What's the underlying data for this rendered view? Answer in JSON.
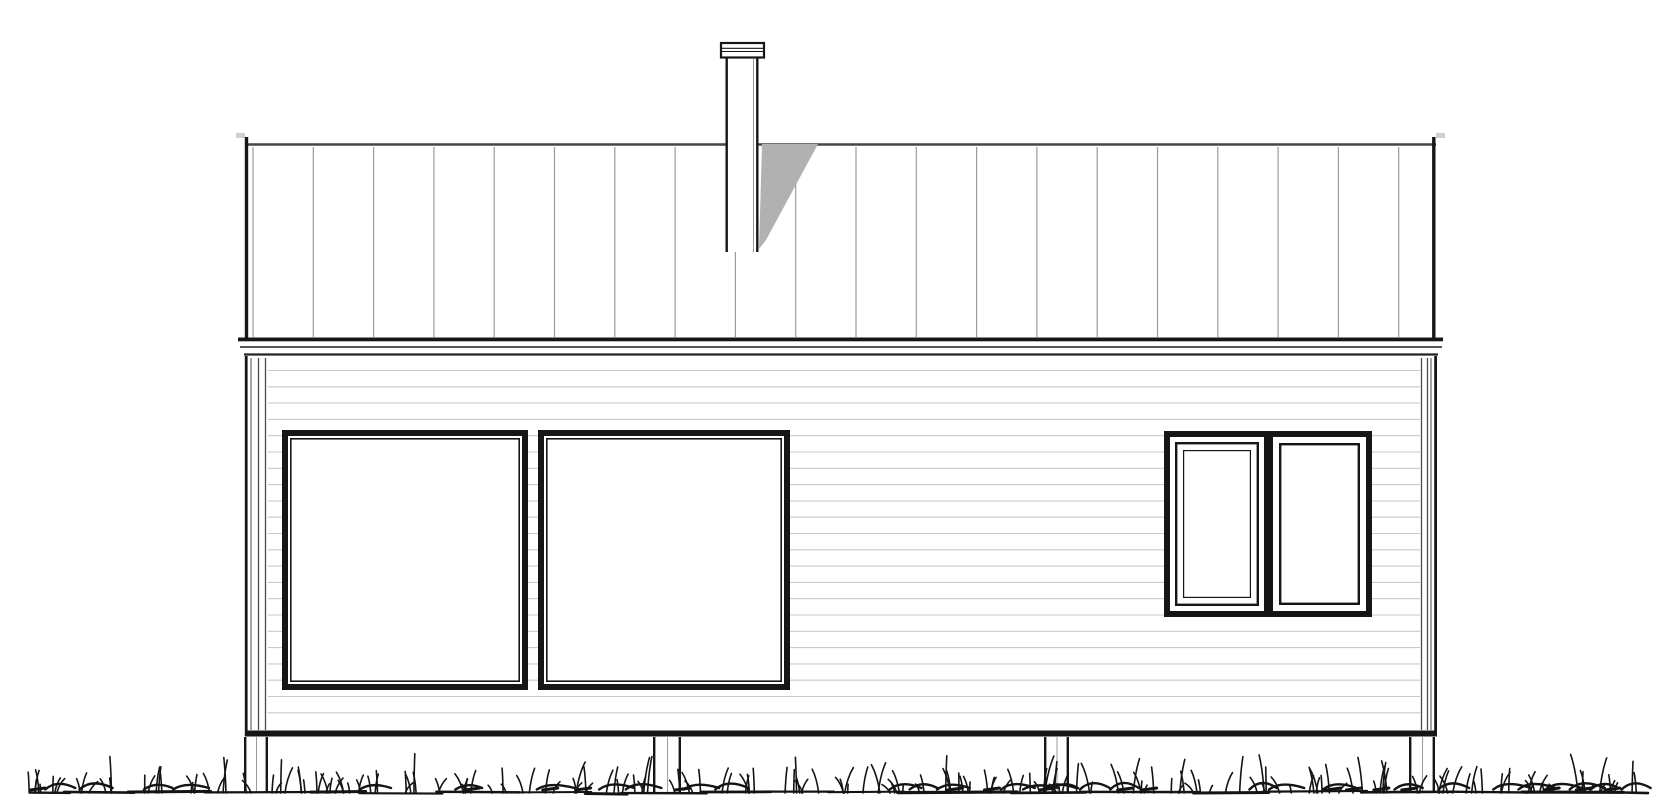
{
  "scene": {
    "width": 1670,
    "height": 800,
    "background": "#ffffff"
  },
  "palette": {
    "line_dark": "#161616",
    "line_medium": "#3f3f3f",
    "roof_top_line": "#474747",
    "roof_seam_gray": "#9b9b9b",
    "siding_gray": "#c9c9c9",
    "shadow_gray": "#b1b1b1",
    "grass_black": "#141414",
    "fill_white": "#ffffff",
    "post_inner_gray": "#999999",
    "corner_line_gray": "#4a4a4a"
  },
  "roof": {
    "x": 245,
    "right": 1436,
    "top_line_y": 144.5,
    "eave_y": 337,
    "edge_left_x": 246.5,
    "edge_right_x": 1433.8,
    "edge_top_y": 137,
    "edge_bottom_y": 338.5,
    "seam_first_x": 253,
    "seam_spacing": 60.3,
    "seam_count": 20,
    "seam_top_y": 147,
    "seam_bottom_y": 337
  },
  "fascia": {
    "board": {
      "x": 238,
      "y": 337.5,
      "w": 1205,
      "h": 3.8
    },
    "mid_line": {
      "x1": 240,
      "x2": 1442,
      "y": 347,
      "w": 1.8
    },
    "bottom_line": {
      "x1": 244,
      "x2": 1438,
      "y": 354.5,
      "w": 2.2
    }
  },
  "chimney": {
    "cap": {
      "x": 721,
      "y": 43,
      "w": 43,
      "h": 14.5,
      "inner_line_ys": [
        48.3,
        51.5
      ]
    },
    "body": {
      "x": 725.5,
      "y": 57,
      "w": 33,
      "bottom_y": 252
    }
  },
  "chimney_shadow": {
    "points": "762,144 818,144 766,240 759,249"
  },
  "wall": {
    "x": 245,
    "y": 356,
    "w": 1192,
    "bottom_y": 737,
    "left_edge_x": 246.2,
    "right_edge_x": 1435.6,
    "siding_first_y": 370.5,
    "siding_pitch": 16.3,
    "siding_last_y": 727,
    "siding_left_x": 268,
    "siding_right_x": 1420,
    "base_band": {
      "y": 730.5,
      "h": 6
    }
  },
  "corner_boards": {
    "left": {
      "thin_x": 251,
      "lines_x": [
        258.5,
        265.5
      ]
    },
    "right": {
      "thin_x": 1431,
      "lines_x": [
        1421.5,
        1427.5
      ]
    },
    "top_y": 358,
    "bottom_y": 730
  },
  "windows": {
    "large": [
      {
        "x": 282,
        "y": 430,
        "w": 246,
        "h": 260,
        "frame": 6,
        "inner_inset": 8.8,
        "inner_stroke": 1.6
      },
      {
        "x": 538,
        "y": 430,
        "w": 252,
        "h": 260,
        "frame": 6,
        "inner_inset": 8.8,
        "inner_stroke": 1.6
      }
    ],
    "pair": {
      "x": 1164,
      "y": 431,
      "w": 208,
      "h": 186,
      "frame": 6,
      "divider": {
        "x": 1264,
        "w": 9
      },
      "casement_sash_outer": {
        "x1": 1175,
        "y1": 442,
        "x2": 1259,
        "y2": 606,
        "stroke": 2.4
      },
      "casement_sash_inner": {
        "x1": 1183,
        "y1": 450,
        "x2": 1251,
        "y2": 598,
        "stroke": 1.2
      },
      "fixed_pane_frame": {
        "x1": 1279,
        "y1": 443,
        "x2": 1360,
        "y2": 605,
        "stroke": 2.4
      }
    }
  },
  "posts": {
    "top_y": 737,
    "bottom_y": 792,
    "edge_stroke": 2.4,
    "items": [
      {
        "x": 244,
        "w": 24
      },
      {
        "x": 653,
        "w": 28
      },
      {
        "x": 1044,
        "w": 25
      },
      {
        "x": 1409,
        "w": 26
      }
    ]
  },
  "grass": {
    "baseline_y": 792.5,
    "x_start": 30,
    "x_end": 1648,
    "seed": 42,
    "blade_min_h": 7,
    "blade_max_h": 26,
    "tall_blade_h": 33
  }
}
